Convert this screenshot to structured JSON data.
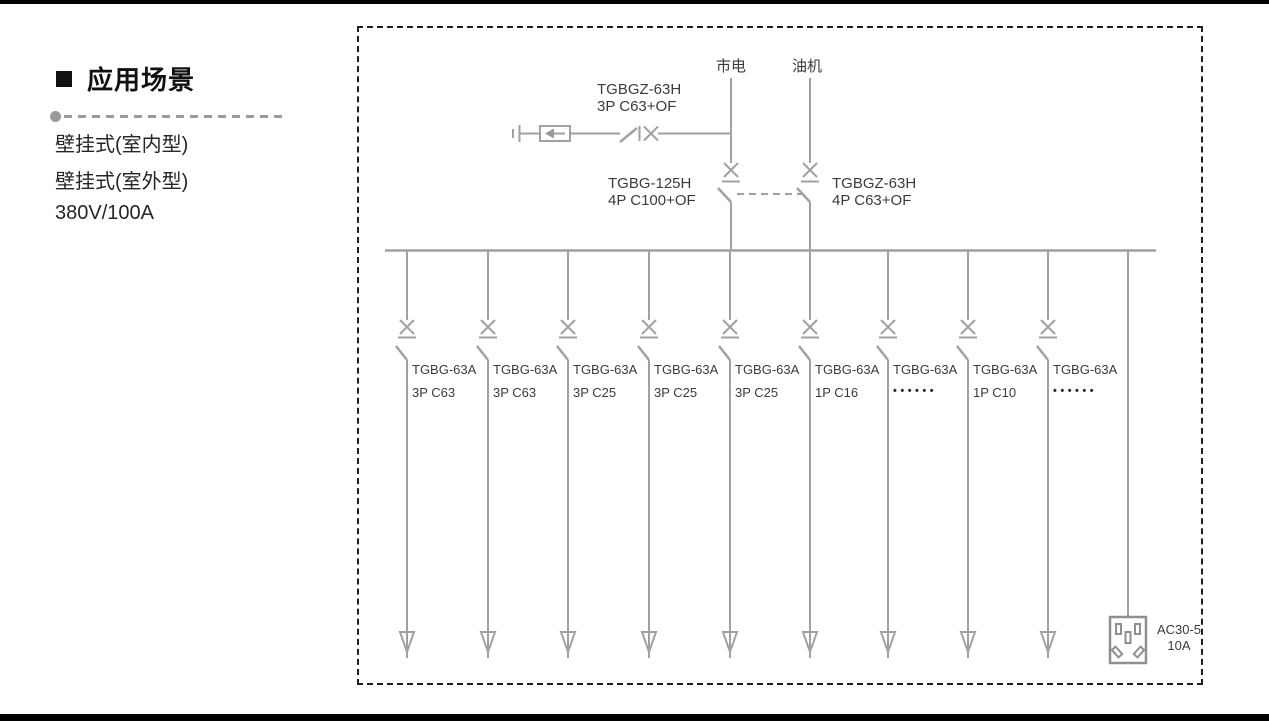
{
  "sidebar": {
    "heading": "应用场景",
    "items": [
      "壁挂式(室内型)",
      "壁挂式(室外型)",
      "380V/100A"
    ]
  },
  "diagram": {
    "sources": {
      "mains": "市电",
      "generator": "油机"
    },
    "spd_breaker": {
      "model": "TGBGZ-63H",
      "spec": "3P C63+OF"
    },
    "mains_breaker": {
      "model": "TGBG-125H",
      "spec": "4P C100+OF"
    },
    "generator_breaker": {
      "model": "TGBGZ-63H",
      "spec": "4P C63+OF"
    },
    "branches": [
      {
        "model": "TGBG-63A",
        "spec": "3P C63"
      },
      {
        "model": "TGBG-63A",
        "spec": "3P C63"
      },
      {
        "model": "TGBG-63A",
        "spec": "3P C25"
      },
      {
        "model": "TGBG-63A",
        "spec": "3P C25"
      },
      {
        "model": "TGBG-63A",
        "spec": "3P C25"
      },
      {
        "model": "TGBG-63A",
        "spec": "1P C16"
      },
      {
        "model": "TGBG-63A",
        "spec": "••••••"
      },
      {
        "model": "TGBG-63A",
        "spec": "1P C10"
      },
      {
        "model": "TGBG-63A",
        "spec": "••••••"
      }
    ],
    "socket": {
      "model": "AC30-5",
      "rating": "10A"
    },
    "colors": {
      "line": "#a1a1a1",
      "text": "#3b3b3b",
      "frame": "#1f1f1f",
      "bar": "#000000"
    }
  }
}
